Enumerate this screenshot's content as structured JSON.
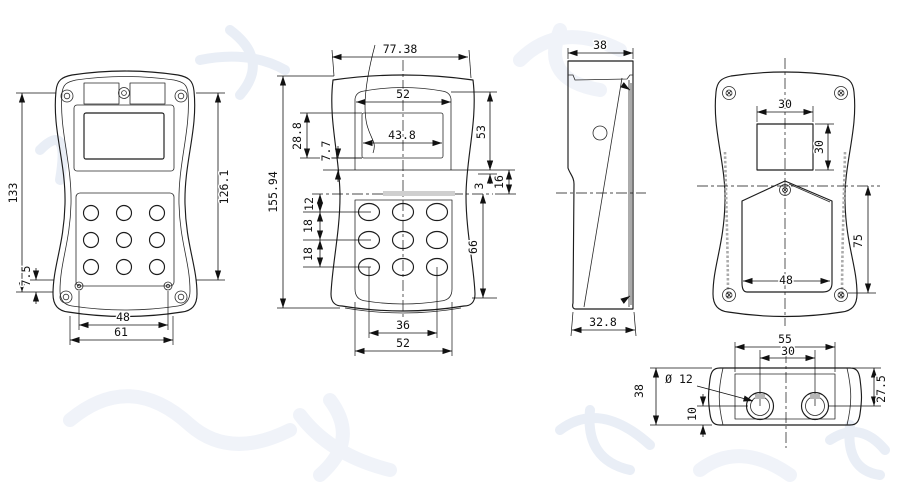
{
  "drawing": {
    "front_shaded": {
      "overall_height": "133",
      "inner_height": "126.1",
      "base_offset": "7.5",
      "screw_span": "48",
      "base_width": "61"
    },
    "front": {
      "top_width": "77.38",
      "overall_height": "155.94",
      "bezel_width": "52",
      "display_width": "43.8",
      "display_height": "28.8",
      "display_gap": "7.7",
      "bezel_height": "53",
      "recess_gap": "3",
      "waist_gap": "16",
      "key_offset": "12",
      "key_pitch_a": "18",
      "key_pitch_b": "18",
      "keypad_height": "66",
      "key_span": "36",
      "keypad_width": "52"
    },
    "side": {
      "top_depth": "38",
      "base_depth": "32.8"
    },
    "back": {
      "window_width": "30",
      "window_height": "30",
      "cover_width": "48",
      "cover_height": "75"
    },
    "bottom": {
      "body_width": "55",
      "port_span": "30",
      "port_dia": "Ø 12",
      "depth": "38",
      "port_offset": "10",
      "port_height": "27.5"
    }
  }
}
